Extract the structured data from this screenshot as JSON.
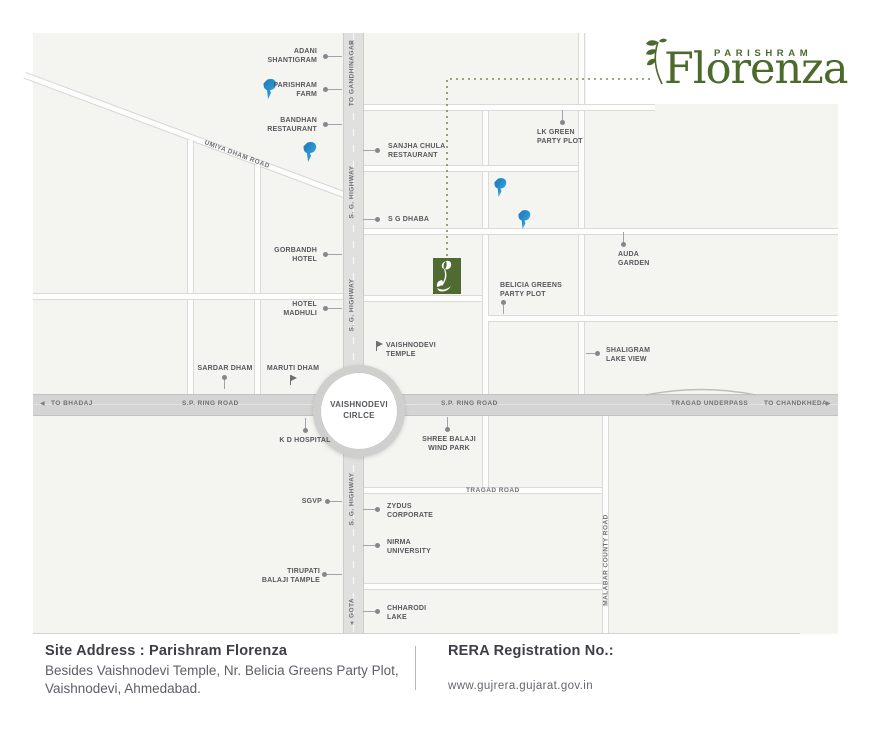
{
  "logo": {
    "brand": "PARISHRAM",
    "name": "Florenza"
  },
  "colors": {
    "accent_green": "#4c6a2c",
    "marker_green": "#4f6b31",
    "parishram_blue": "#1c74b8",
    "road_gray": "#d4d4d4"
  },
  "map": {
    "circle": {
      "label": "VAISHNODEVI\nCIRLCE"
    },
    "roads": {
      "sg_highway_1": "S. G. HIGHWAY",
      "sg_highway_2": "S. G. HIGHWAY",
      "sg_highway_3": "S. G. HIGHWAY",
      "to_gandhinagar": "TO GANDHINAGAR",
      "gota": "GOTA",
      "sp_ring_road_left": "S.P. RING ROAD",
      "sp_ring_road_right": "S.P. RING ROAD",
      "to_bhadaj": "TO BHADAJ",
      "tragad_underpass": "TRAGAD UNDERPASS",
      "to_chandkheda": "TO CHANDKHEDA",
      "tragad_road": "TRAGAD ROAD",
      "malabar_county_road": "MALABAR COUNTY ROAD",
      "umiya_dham_road": "UMIYA DHAM ROAD"
    },
    "arrows": {
      "up": "▲",
      "down": "▼",
      "left": "◀",
      "right": "▶"
    },
    "landmarks": {
      "adani": "ADANI\nSHANTIGRAM",
      "parishram_farm": "PARISHRAM\nFARM",
      "bandhan": "BANDHAN\nRESTAURANT",
      "sanjha": "SANJHA CHULA\nRESTAURANT",
      "sg_dhaba": "S G DHABA",
      "lk_green": "LK GREEN\nPARTY PLOT",
      "gorbandh": "GORBANDH\nHOTEL",
      "hotel_madhuli": "HOTEL\nMADHULI",
      "auda_garden": "AUDA\nGARDEN",
      "belicia": "BELICIA GREENS\nPARTY PLOT",
      "shaligram": "SHALIGRAM\nLAKE VIEW",
      "vaishnodevi_temple": "VAISHNODEVI\nTEMPLE",
      "sardar_dham": "SARDAR DHAM",
      "maruti_dham": "MARUTI DHAM",
      "kd_hospital": "K D HOSPITAL",
      "shree_balaji": "SHREE BALAJI\nWIND PARK",
      "sgvp": "SGVP",
      "zydus": "ZYDUS\nCORPORATE",
      "nirma": "NIRMA\nUNIVERSITY",
      "tirupati": "TIRUPATI\nBALAJI TAMPLE",
      "chharodi": "CHHARODI\nLAKE"
    }
  },
  "footer": {
    "site_address_title": "Site Address : Parishram Florenza",
    "site_address_body": "Besides Vaishnodevi Temple, Nr. Belicia Greens Party Plot,\nVaishnodevi, Ahmedabad.",
    "rera_title": "RERA Registration No.:",
    "rera_url": "www.gujrera.gujarat.gov.in"
  }
}
